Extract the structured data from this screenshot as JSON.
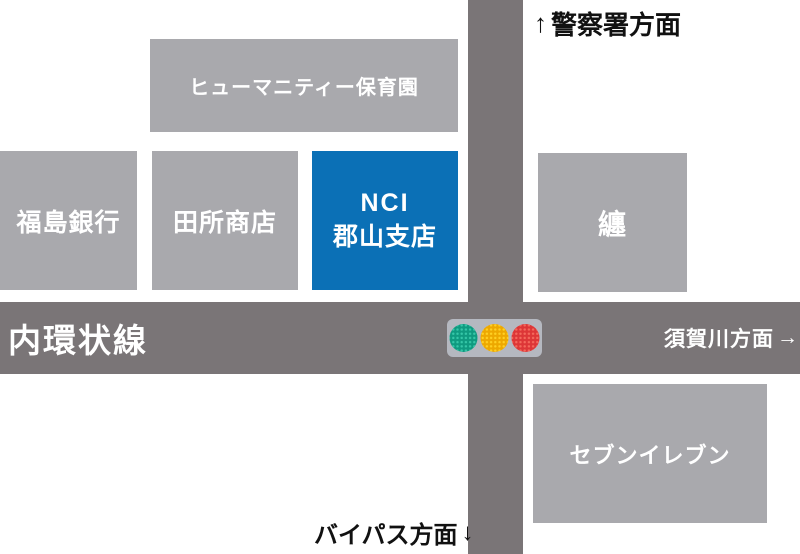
{
  "buildings": {
    "nursery": {
      "label": "ヒューマニティー保育園",
      "color": "#a9a9ad"
    },
    "bank": {
      "label": "福島銀行",
      "color": "#a9a9ad"
    },
    "tadokoro": {
      "label": "田所商店",
      "color": "#a9a9ad"
    },
    "nci": {
      "line1": "NCI",
      "line2": "郡山支店",
      "color": "#0b70b6"
    },
    "matoi": {
      "label": "纏",
      "color": "#a9a9ad"
    },
    "seven_eleven": {
      "label": "セブンイレブン",
      "color": "#a9a9ad"
    }
  },
  "roads": {
    "color": "#7a7577",
    "horizontal_name": "内環状線"
  },
  "directions": {
    "north": {
      "arrow": "↑",
      "text": "警察署方面"
    },
    "east": {
      "text": "須賀川方面",
      "arrow": "→"
    },
    "south": {
      "text": "バイパス方面",
      "arrow": "↓"
    }
  },
  "traffic_light": {
    "housing": "#b5b8c0",
    "lights": [
      {
        "name": "green",
        "base": "#0f9a80",
        "dot": "#35c7a8"
      },
      {
        "name": "yellow",
        "base": "#eda800",
        "dot": "#ffd023"
      },
      {
        "name": "red",
        "base": "#dd3637",
        "dot": "#f4695c"
      }
    ]
  }
}
